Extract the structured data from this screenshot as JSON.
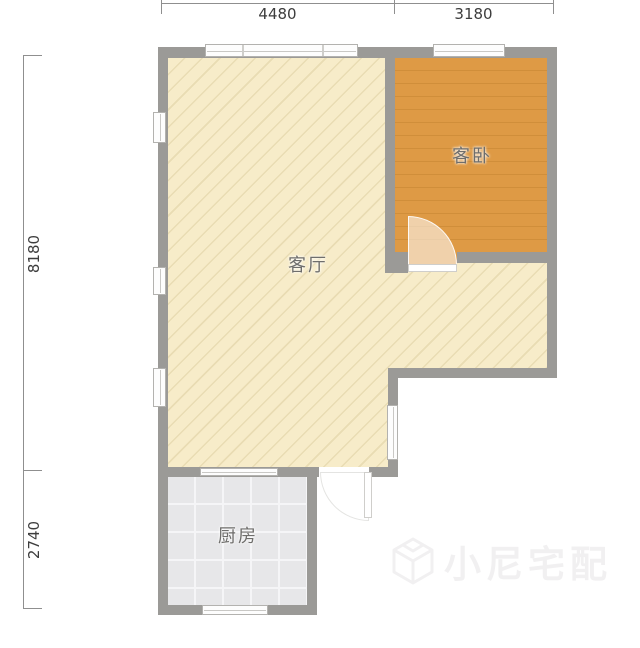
{
  "floorplan": {
    "dimensions": {
      "top": [
        {
          "value": "4480"
        },
        {
          "value": "3180"
        }
      ],
      "left": [
        {
          "value": "8180"
        },
        {
          "value": "2740"
        }
      ]
    },
    "rooms": {
      "living": {
        "label": "客厅"
      },
      "bedroom": {
        "label": "客卧"
      },
      "kitchen": {
        "label": "厨房"
      }
    },
    "watermark": {
      "text": "小尼宅配"
    },
    "colors": {
      "wall": "#9b9a97",
      "living_floor": "#f7ecc9",
      "living_hatch": "#e9dcb3",
      "bedroom_floor": "#de9a45",
      "kitchen_floor": "#e7e7e9",
      "dimension_text": "#3d3d3d",
      "room_label_text": "#6f6e6c",
      "watermark_gray": "#f1f0f1"
    }
  }
}
